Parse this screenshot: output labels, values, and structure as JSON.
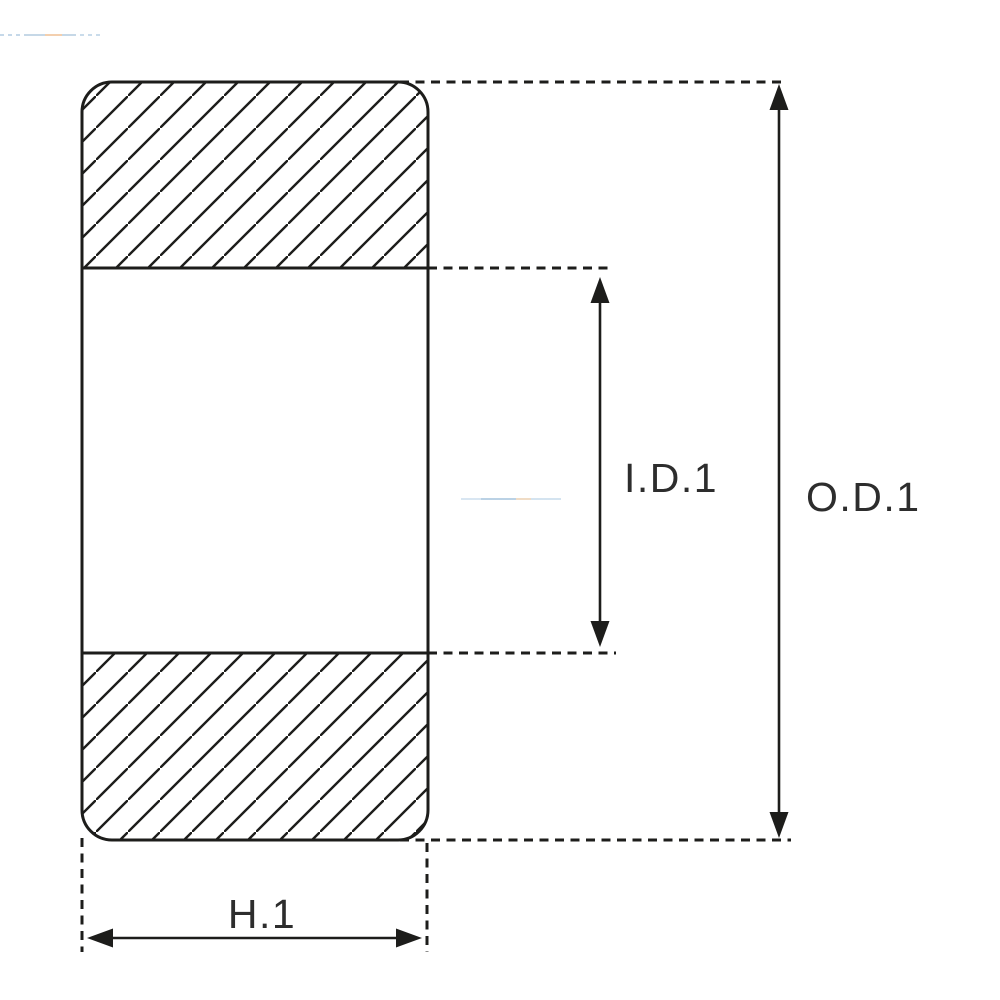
{
  "diagram": {
    "labels": {
      "inner_diameter": "I.D.1",
      "outer_diameter": "O.D.1",
      "height": "H.1"
    },
    "colors": {
      "line": "#1d1d1b",
      "text": "#2d2d2d",
      "background": "#ffffff",
      "watermark": "#b9cfe2"
    }
  }
}
